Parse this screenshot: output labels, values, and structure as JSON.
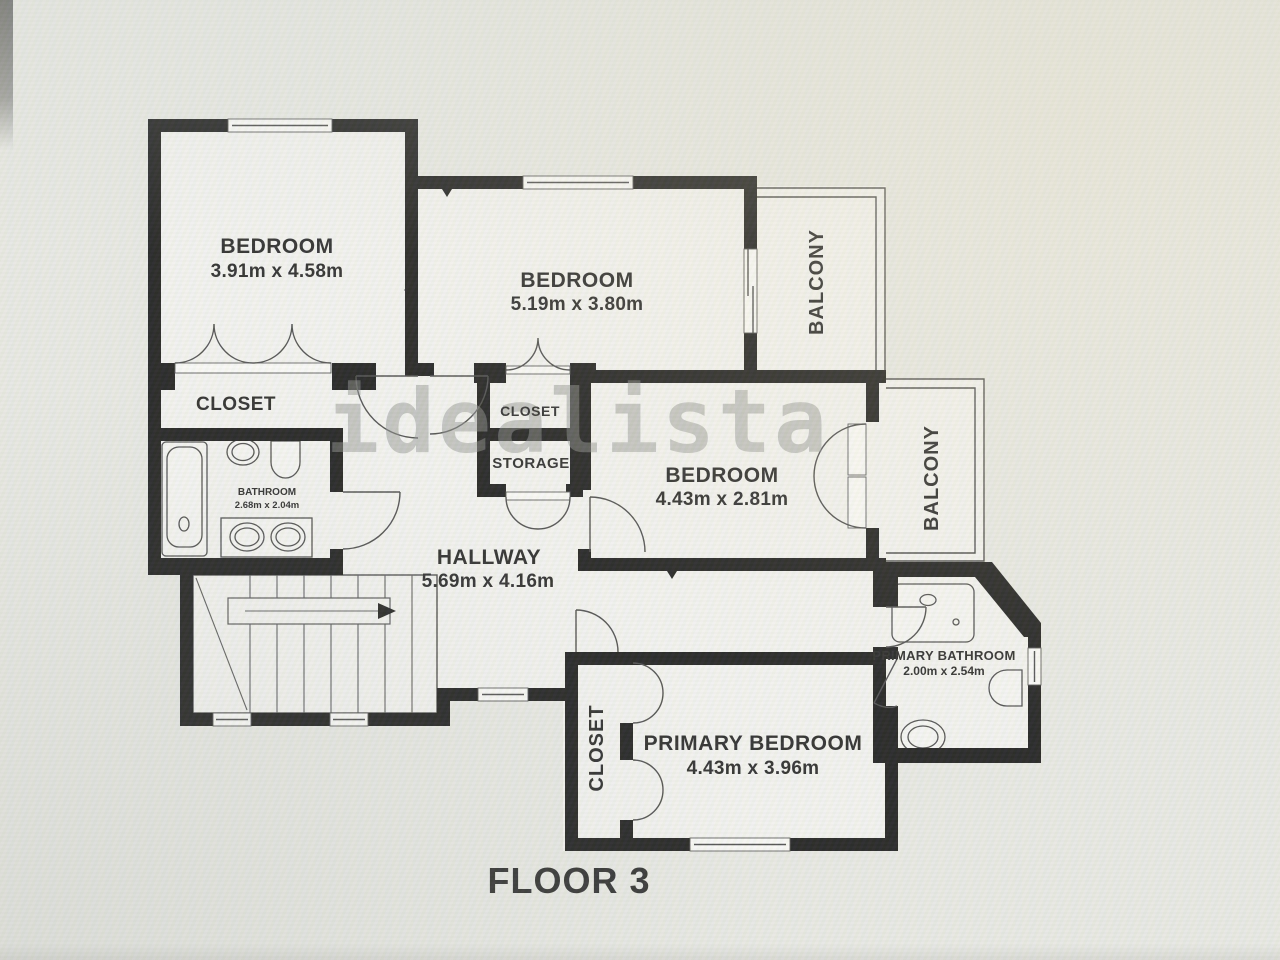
{
  "floorplan": {
    "watermark": "idealista",
    "floor_label": "FLOOR 3",
    "rooms": {
      "bedroom1": {
        "label": "BEDROOM",
        "dims": "3.91m x 4.58m"
      },
      "bedroom2": {
        "label": "BEDROOM",
        "dims": "5.19m x 3.80m"
      },
      "bedroom3": {
        "label": "BEDROOM",
        "dims": "4.43m x 2.81m"
      },
      "primary_bedroom": {
        "label": "PRIMARY BEDROOM",
        "dims": "4.43m x 3.96m"
      },
      "hallway": {
        "label": "HALLWAY",
        "dims": "5.69m x 4.16m"
      },
      "bathroom": {
        "label": "BATHROOM",
        "dims": "2.68m x 2.04m"
      },
      "primary_bathroom": {
        "label": "PRIMARY BATHROOM",
        "dims": "2.00m x 2.54m"
      },
      "closet_bedroom1": {
        "label": "CLOSET"
      },
      "closet_mid": {
        "label": "CLOSET"
      },
      "storage": {
        "label": "STORAGE"
      },
      "closet_primary": {
        "label": "CLOSET"
      },
      "balcony_top": {
        "label": "BALCONY"
      },
      "balcony_right": {
        "label": "BALCONY"
      }
    },
    "colors": {
      "wall": "#1a1a1a",
      "background": "#e9eae5",
      "room_fill": "#f4f4f1",
      "watermark_gray": "#8d908c"
    }
  }
}
